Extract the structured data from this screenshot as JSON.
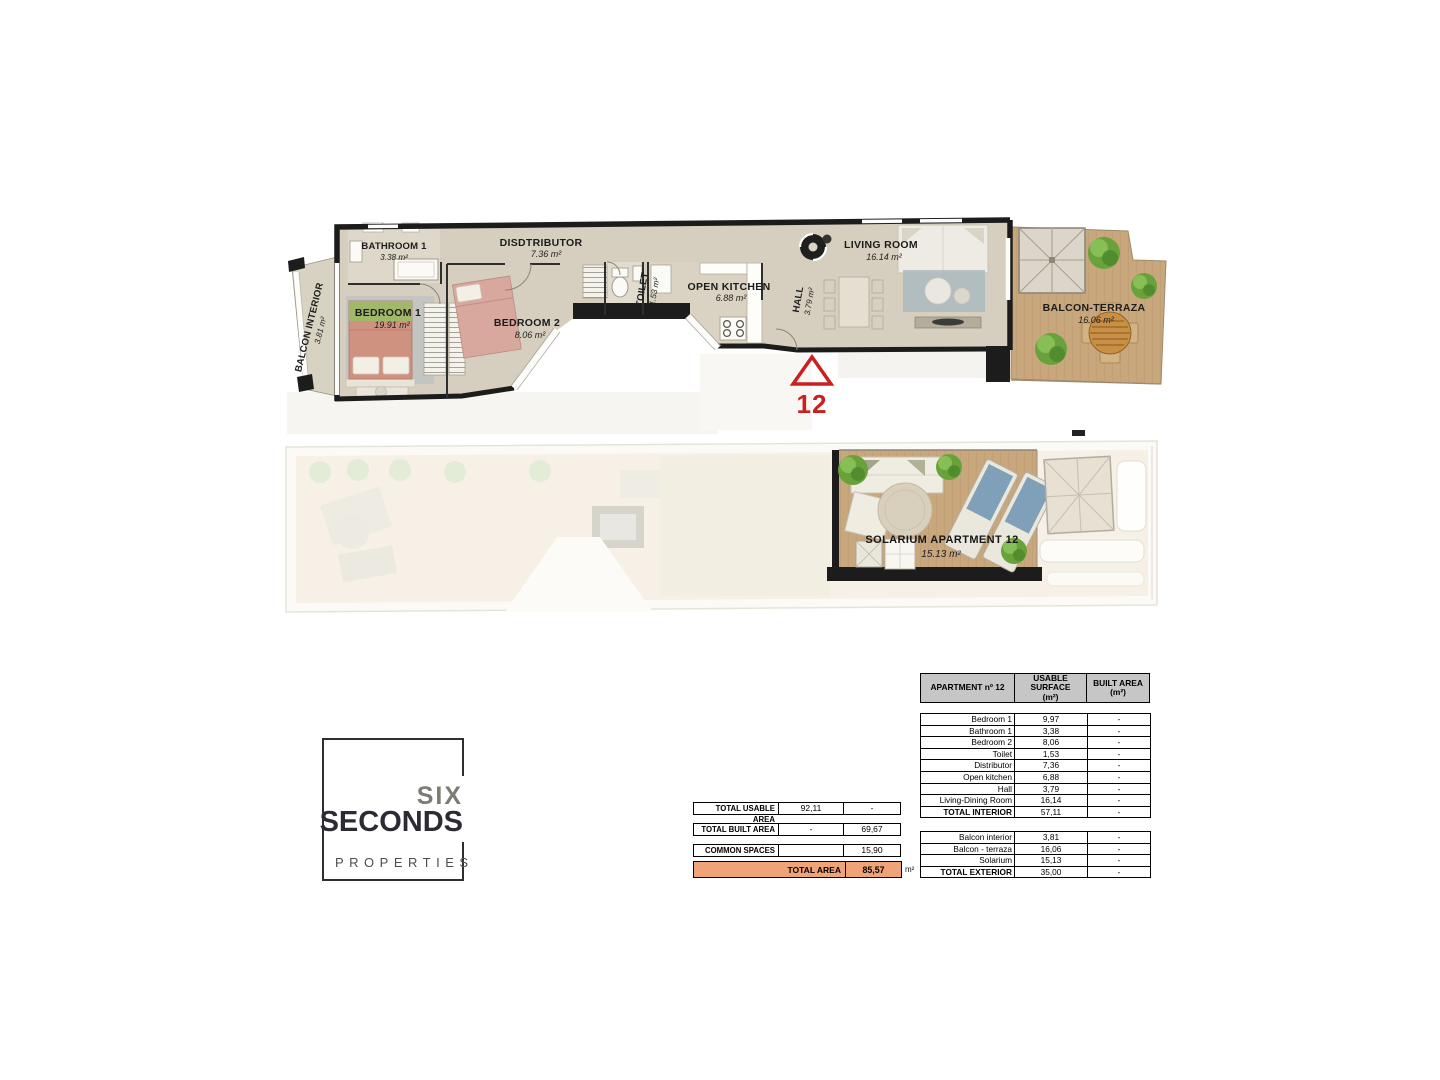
{
  "plan": {
    "balcon_interior": {
      "name": "BALCON INTERIOR",
      "area": "3.81 m²"
    },
    "bathroom1": {
      "name": "BATHROOM 1",
      "area": "3.38 m²"
    },
    "bedroom1": {
      "name": "BEDROOM 1",
      "area": "19.91 m²"
    },
    "bedroom2": {
      "name": "BEDROOM 2",
      "area": "8.06 m²"
    },
    "distributor": {
      "name": "DISDTRIBUTOR",
      "area": "7.36 m²"
    },
    "toilet": {
      "name": "TOILET",
      "area": "1.53 m²"
    },
    "open_kitchen": {
      "name": "OPEN KITCHEN",
      "area": "6.88 m²"
    },
    "hall": {
      "name": "HALL",
      "area": "3.79 m²"
    },
    "living_room": {
      "name": "LIVING ROOM",
      "area": "16.14 m²"
    },
    "balcon_terraza": {
      "name": "BALCON-TERRAZA",
      "area": "16.06 m²"
    },
    "solarium": {
      "name": "SOLARIUM APARTMENT 12",
      "area": "15.13 m²"
    },
    "marker_number": "12"
  },
  "logo": {
    "word1": "SIX",
    "word2": "SECONDS",
    "word3": "PROPERTIES"
  },
  "summary_table": {
    "rows": [
      {
        "label": "TOTAL USABLE AREA",
        "usable": "92,11",
        "built": "-"
      },
      {
        "label": "TOTAL BUILT AREA",
        "usable": "-",
        "built": "69,67"
      },
      {
        "label": "COMMON SPACES",
        "usable": "",
        "built": "15,90"
      }
    ],
    "total": {
      "label": "TOTAL AREA",
      "value": "85,57",
      "unit": "m²"
    }
  },
  "detail_table": {
    "header": {
      "col1": "APARTMENT nº 12",
      "col2_line1": "USABLE SURFACE",
      "col2_line2": "(m²)",
      "col3_line1": "BUILT AREA",
      "col3_line2": "(m²)"
    },
    "interior": [
      {
        "label": "Bedroom 1",
        "usable": "9,97",
        "built": "-"
      },
      {
        "label": "Bathroom 1",
        "usable": "3,38",
        "built": "-"
      },
      {
        "label": "Bedroom 2",
        "usable": "8,06",
        "built": "-"
      },
      {
        "label": "Toilet",
        "usable": "1,53",
        "built": "-"
      },
      {
        "label": "Distributor",
        "usable": "7,36",
        "built": "-"
      },
      {
        "label": "Open kitchen",
        "usable": "6,88",
        "built": "-"
      },
      {
        "label": "Hall",
        "usable": "3,79",
        "built": "-"
      },
      {
        "label": "Living-Dining Room",
        "usable": "16,14",
        "built": "-"
      },
      {
        "label": "TOTAL INTERIOR",
        "usable": "57,11",
        "built": "-"
      }
    ],
    "exterior": [
      {
        "label": "Balcon interior",
        "usable": "3,81",
        "built": "-"
      },
      {
        "label": "Balcon - terraza",
        "usable": "16,06",
        "built": "-"
      },
      {
        "label": "Solarium",
        "usable": "15,13",
        "built": "-"
      },
      {
        "label": "TOTAL EXTERIOR",
        "usable": "35,00",
        "built": "-"
      }
    ]
  },
  "colors": {
    "accent_orange": "#efa377",
    "wall_black": "#1c1c1c",
    "deck_wood": "#c8a77d",
    "floor_stone": "#d6cfbf"
  }
}
